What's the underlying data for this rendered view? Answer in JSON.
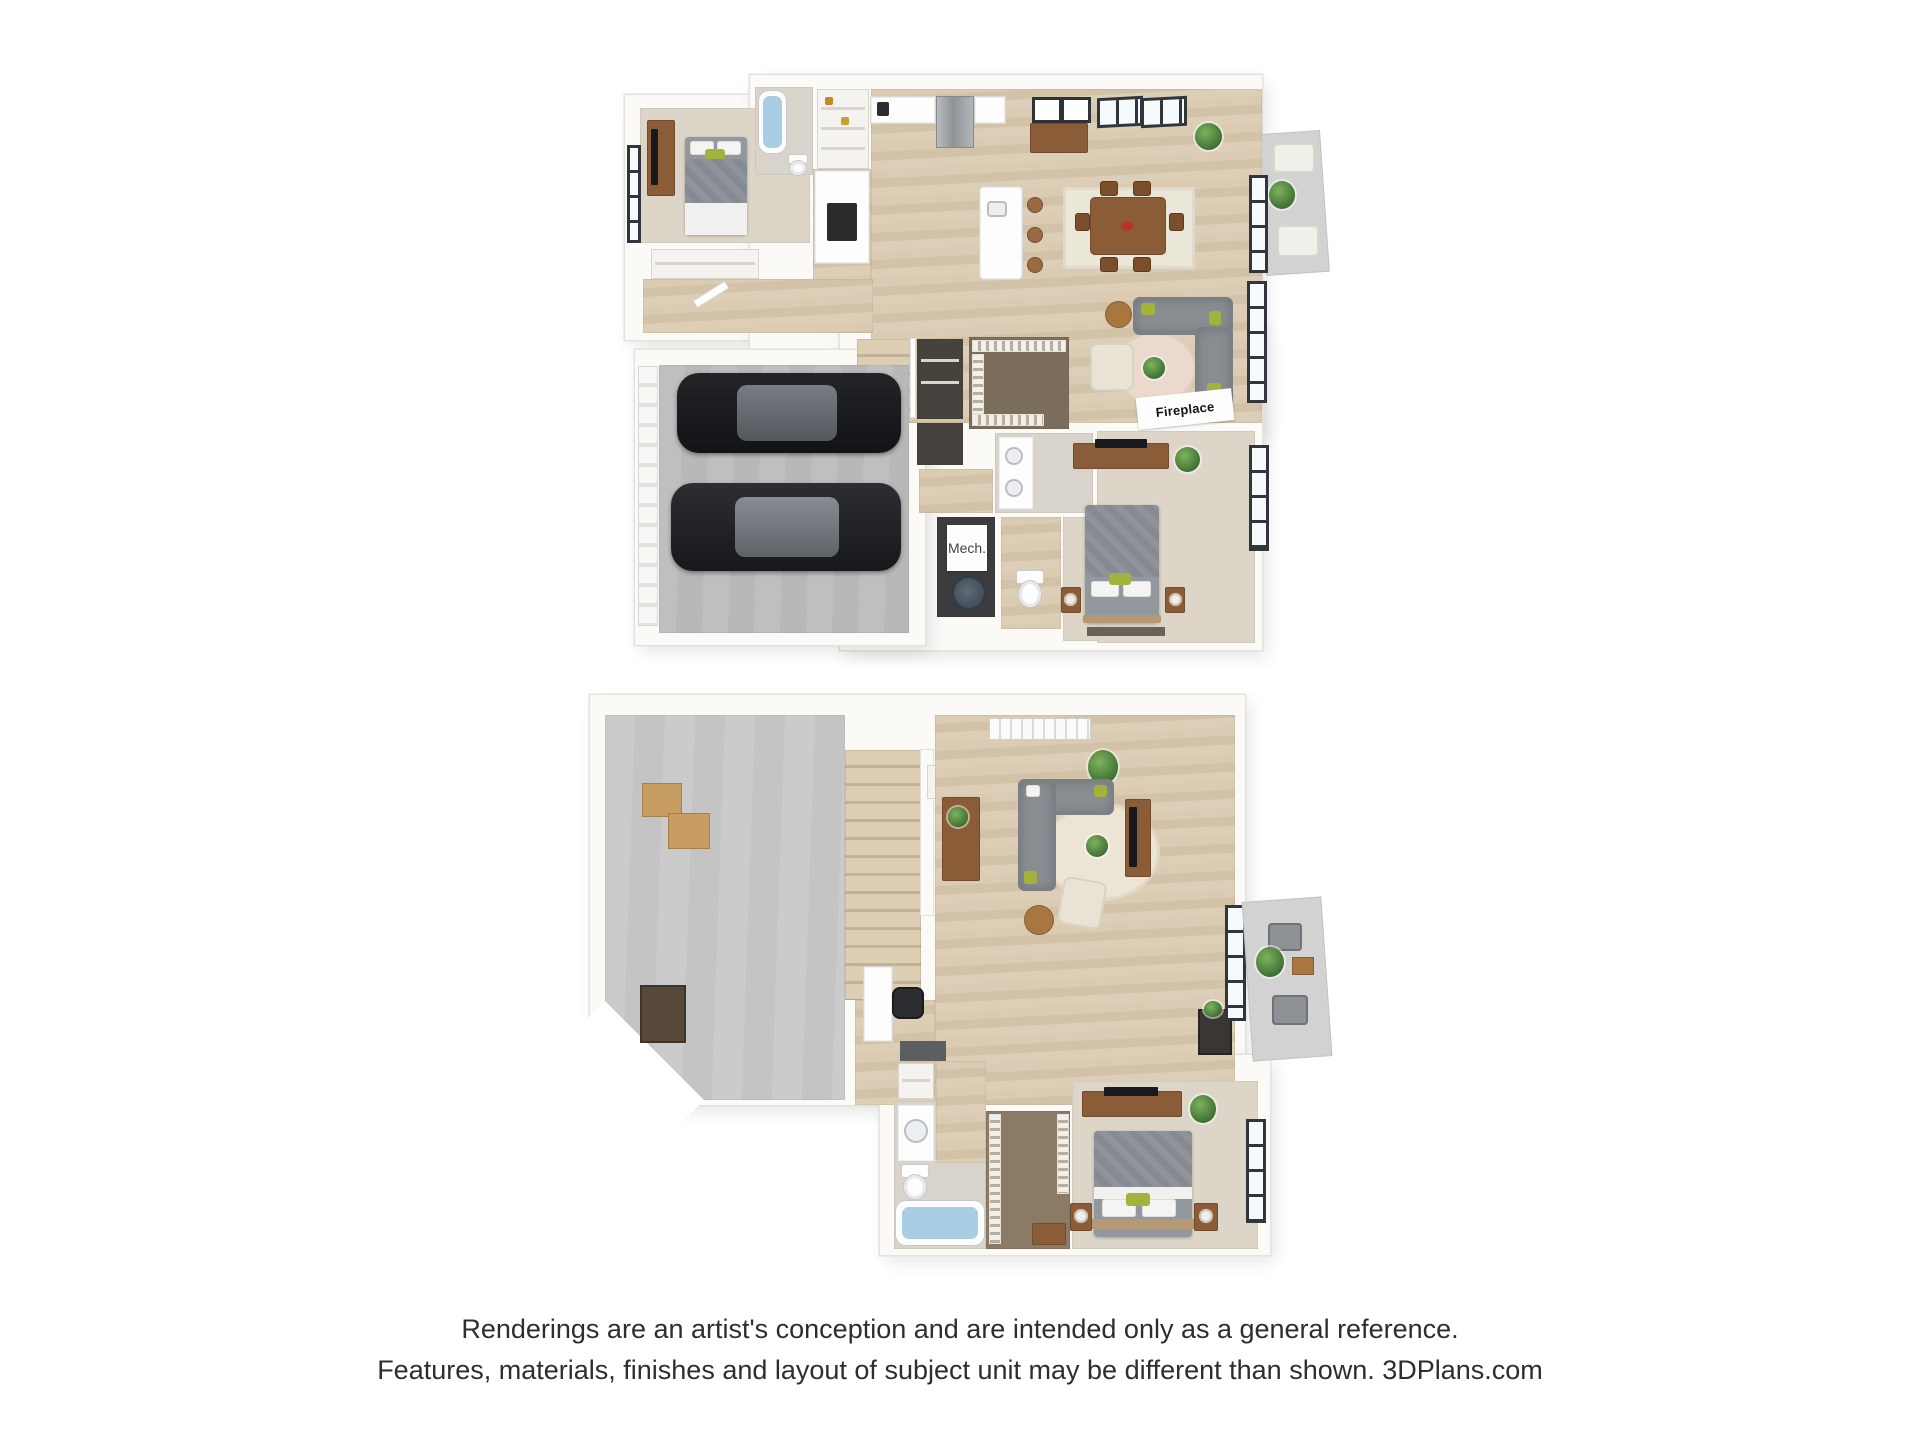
{
  "page": {
    "background": "#ffffff",
    "description_type": "3d-floor-plan-rendering",
    "plan_count": 2
  },
  "plan1": {
    "fireplace_label": "Fireplace",
    "mech_label": "Mech."
  },
  "plan2": {},
  "disclaimer": {
    "line1": "Renderings are an artist's conception and are intended only as a general reference.",
    "line2": "Features, materials, finishes and layout of subject unit may be different than shown. 3DPlans.com"
  },
  "palette": {
    "background": "#ffffff",
    "wall": "#fbfaf7",
    "wall_edge": "#e4e2dd",
    "wood_floor": "#d7c8ae",
    "carpet": "#ddd6c8",
    "concrete": "#bdbdbd",
    "closet_floor": "#7b6d5b",
    "sofa_gray": "#898d92",
    "furniture_wood": "#8a5c38",
    "plant_green": "#4e7d3c",
    "tub_water_blue": "#a9cde2",
    "window_frame": "#31363d",
    "car_black": "#1b1c1f",
    "disclaimer_text": "#2e2e2e"
  }
}
